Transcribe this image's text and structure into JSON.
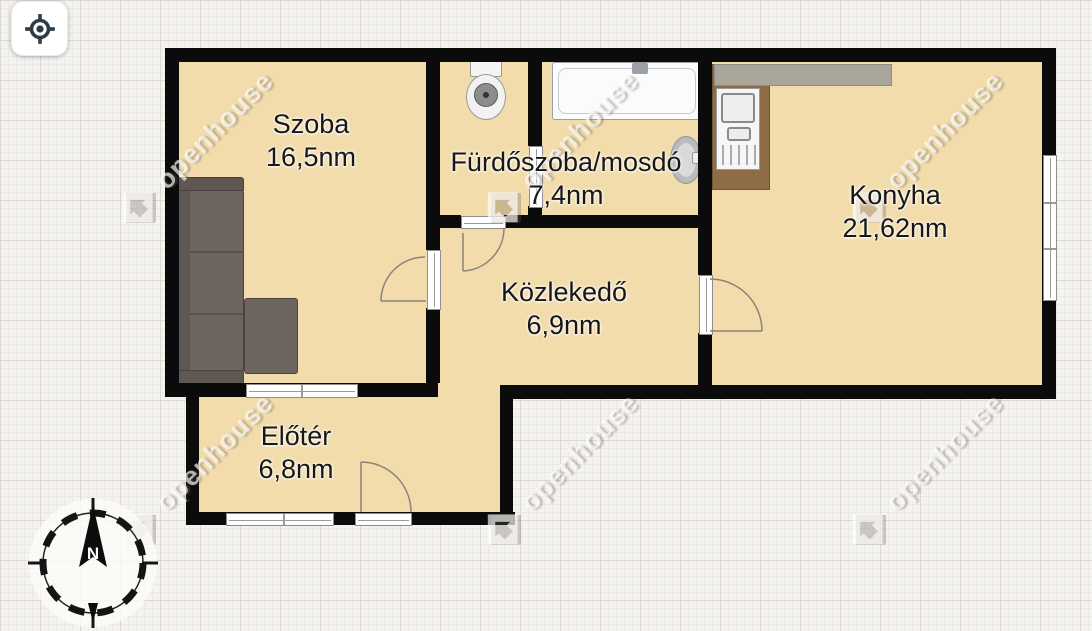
{
  "toolbar": {
    "locate_button": {
      "icon": "crosshair-locate-icon"
    }
  },
  "floorplan": {
    "rooms": [
      {
        "id": "szoba",
        "name": "Szoba",
        "area": "16,5nm"
      },
      {
        "id": "furdoszoba-mosdo",
        "name": "Fürdőszoba/mosdó",
        "area": "7,4nm"
      },
      {
        "id": "konyha",
        "name": "Konyha",
        "area": "21,62nm"
      },
      {
        "id": "kozlekedo",
        "name": "Közlekedő",
        "area": "6,9nm"
      },
      {
        "id": "eloter",
        "name": "Előtér",
        "area": "6,8nm"
      }
    ],
    "fixtures": [
      "sofa",
      "toilet",
      "bathtub",
      "washbasin",
      "kitchen-counter",
      "kitchen-sink"
    ],
    "compass": {
      "north_label": "N"
    },
    "watermark": {
      "text": "openhouse",
      "logo": "openhouse-diamond-logo"
    },
    "colors": {
      "floor": "#f2dcab",
      "wall": "#0b0b0b",
      "background": "#f4f3f0",
      "grid_line": "#dcd9d3",
      "counter_wood": "#8d6c46",
      "counter_gray": "#a9a59a",
      "sofa": "#6e6560",
      "icon": "#2e3c48"
    }
  }
}
